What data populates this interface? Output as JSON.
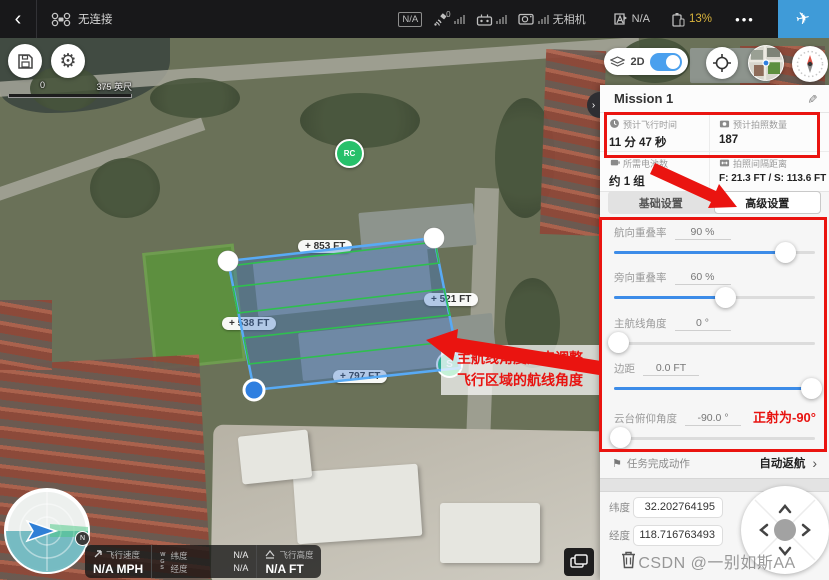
{
  "icons": {
    "back": "‹",
    "more": "•••",
    "takeoff": "✈",
    "edit": "✎",
    "gear": "⚙",
    "chevron": "›",
    "flag": "⚑"
  },
  "topbar": {
    "connection": "无连接",
    "link_badge": "N/A",
    "gps_count": "0",
    "camera_status": "无相机",
    "mode_value": "N/A",
    "battery_percent": "13%"
  },
  "map": {
    "scale_zero": "0",
    "scale_distance": "375 英尺",
    "view_toggle": "2D",
    "rc_marker": "RC",
    "start_marker": "S",
    "north_badge": "N",
    "edge_labels": {
      "top": "+ 853 FT",
      "right": "+ 521 FT",
      "left": "+ 538 FT",
      "bottom": "+ 797 FT"
    },
    "annotation_line1": "主航线角度用来调整",
    "annotation_line2": "飞行区域的航线角度"
  },
  "panel": {
    "title": "Mission 1",
    "stats": [
      {
        "icon": "clock-icon",
        "label": "预计飞行时间",
        "value": "11 分 47 秒"
      },
      {
        "icon": "photo-count-icon",
        "label": "预计拍照数量",
        "value": "187"
      },
      {
        "icon": "battery-icon",
        "label": "所需电池数",
        "value": "约 1 组"
      },
      {
        "icon": "interval-icon",
        "label": "拍照间隔距离",
        "value": "F: 21.3 FT / S: 113.6 FT"
      }
    ],
    "tabs": [
      {
        "id": "basic",
        "label": "基础设置",
        "active": false
      },
      {
        "id": "advanced",
        "label": "高级设置",
        "active": true
      }
    ],
    "settings": [
      {
        "label": "航向重叠率",
        "value": "90 %",
        "percent": 85
      },
      {
        "label": "旁向重叠率",
        "value": "60 %",
        "percent": 55
      },
      {
        "label": "主航线角度",
        "value": "0 °",
        "percent": 2
      },
      {
        "label": "边距",
        "value": "0.0 FT",
        "percent": 98
      },
      {
        "label": "云台俯仰角度",
        "value": "-90.0 °",
        "percent": 3,
        "note": "正射为-90°"
      }
    ],
    "finish": {
      "label": "任务完成动作",
      "value": "自动返航"
    },
    "coords": [
      {
        "label": "纬度",
        "value": "32.202764195"
      },
      {
        "label": "经度",
        "value": "118.716763493"
      }
    ]
  },
  "statusbar": {
    "speed_label": "飞行速度",
    "speed_value": "N/A MPH",
    "wgs": "W\nG\nS",
    "lat_label": "纬度",
    "lat_value": "N/A",
    "lng_label": "经度",
    "lng_value": "N/A",
    "alt_label": "飞行高度",
    "alt_value": "N/A FT"
  },
  "watermark": "CSDN @一别如斯AA",
  "colors": {
    "accent_blue": "#3c8ce8",
    "annotation_red": "#ea1410",
    "battery_yellow": "#d9b33c",
    "takeoff_blue": "#3f9bd8",
    "polygon_stroke": "#58aaf5",
    "route_green": "#2fbf4f"
  }
}
